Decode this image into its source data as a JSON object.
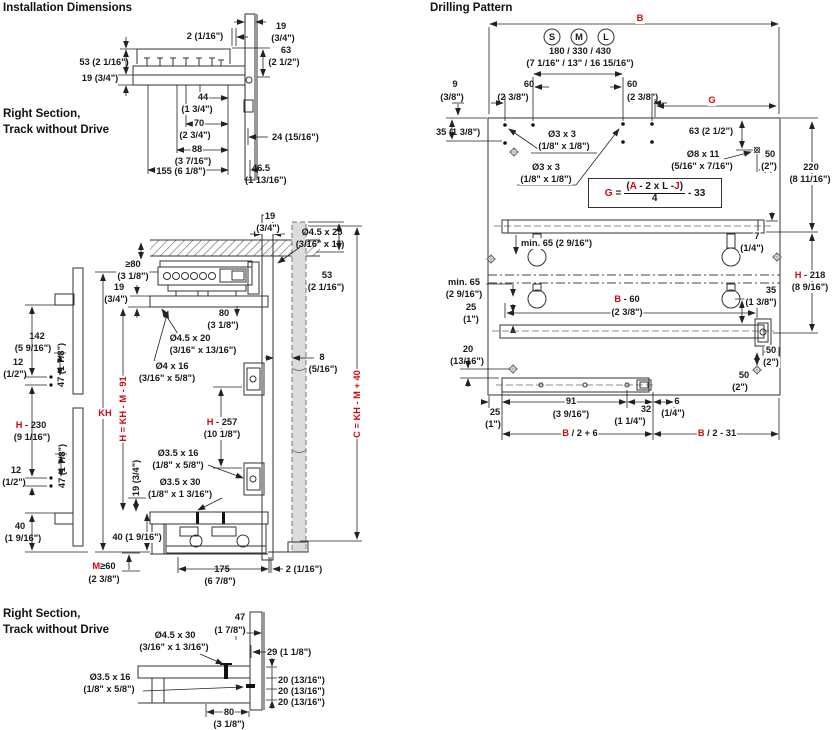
{
  "colors": {
    "red": "#d10a10",
    "ink": "#1a1a1a"
  },
  "headers": {
    "installation": "Installation Dimensions",
    "drilling": "Drilling Pattern",
    "right_section_line1": "Right Section,",
    "right_section_line2": "Track without Drive"
  },
  "drilling": {
    "sizes": [
      "S",
      "M",
      "L"
    ],
    "formula": {
      "lhs": "G",
      "eq": "=",
      "open": "(",
      "a": "A",
      "mid": " - 2 x L -",
      "j": "J",
      "close": ")",
      "den": "4",
      "tail": "- 33"
    }
  },
  "labels": [
    {
      "x": 205,
      "y": 31,
      "t": "2 (1/16\")"
    },
    {
      "x": 281,
      "y": 21,
      "t": "19"
    },
    {
      "x": 283,
      "y": 33,
      "t": "(3/4\")"
    },
    {
      "x": 286,
      "y": 45,
      "t": "63"
    },
    {
      "x": 284,
      "y": 57,
      "t": "(2 1/2\")"
    },
    {
      "x": 104,
      "y": 57,
      "t": "53 (2 1/16\")"
    },
    {
      "x": 100,
      "y": 73,
      "t": "19 (3/4\")"
    },
    {
      "x": 203,
      "y": 92,
      "t": "44",
      "wb": 1
    },
    {
      "x": 197,
      "y": 104,
      "t": "(1 3/4\")",
      "wb": 1
    },
    {
      "x": 199,
      "y": 118,
      "t": "70",
      "wb": 1
    },
    {
      "x": 195,
      "y": 130,
      "t": "(2 3/4\")",
      "wb": 1
    },
    {
      "x": 197,
      "y": 144,
      "t": "88",
      "wb": 1
    },
    {
      "x": 193,
      "y": 156,
      "t": "(3 7/16\")",
      "wb": 1
    },
    {
      "x": 181,
      "y": 166,
      "t": "155 (6 1/8\")",
      "wb": 1
    },
    {
      "x": 272,
      "y": 132,
      "t": "24 (15/16\")",
      "al": "l"
    },
    {
      "x": 252,
      "y": 163,
      "t": "46.5",
      "al": "l"
    },
    {
      "x": 245,
      "y": 175,
      "t": "(1 13/16\")",
      "al": "l"
    },
    {
      "x": 270,
      "y": 211,
      "t": "19",
      "wb": 1
    },
    {
      "x": 268,
      "y": 223,
      "t": "(3/4\")",
      "wb": 1
    },
    {
      "x": 322,
      "y": 227,
      "t": "Ø4.5 x 25"
    },
    {
      "x": 320,
      "y": 239,
      "t": "(3/16\" x 1\")"
    },
    {
      "x": 133,
      "y": 259,
      "t": "≥80",
      "wb": 1
    },
    {
      "x": 133,
      "y": 271,
      "t": "(3 1/8\")",
      "wb": 1
    },
    {
      "x": 119,
      "y": 282,
      "t": "19"
    },
    {
      "x": 116,
      "y": 294,
      "t": "(3/4\")"
    },
    {
      "x": 327,
      "y": 270,
      "t": "53"
    },
    {
      "x": 326,
      "y": 282,
      "t": "(2 1/16\")"
    },
    {
      "x": 224,
      "y": 308,
      "t": "80"
    },
    {
      "x": 223,
      "y": 320,
      "t": "(3 1/8\")"
    },
    {
      "x": 190,
      "y": 333,
      "t": "Ø4.5 x 20",
      "wb": 1
    },
    {
      "x": 203,
      "y": 345,
      "t": "(3/16\" x 13/16\")",
      "wb": 1
    },
    {
      "x": 172,
      "y": 361,
      "t": "Ø4 x 16",
      "wb": 1
    },
    {
      "x": 167,
      "y": 373,
      "t": "(3/16\" x 5/8\")",
      "wb": 1
    },
    {
      "x": 322,
      "y": 352,
      "t": "8"
    },
    {
      "x": 323,
      "y": 364,
      "t": "(5/16\")"
    },
    {
      "x": 222,
      "y": 417,
      "p": [
        {
          "t": "H",
          "r": 1
        },
        {
          "t": " - 257"
        }
      ],
      "wb": 1
    },
    {
      "x": 222,
      "y": 429,
      "t": "(10 1/8\")",
      "wb": 1
    },
    {
      "x": 178,
      "y": 448,
      "t": "Ø3.5 x 16"
    },
    {
      "x": 178,
      "y": 460,
      "t": "(1/8\" x 5/8\")"
    },
    {
      "x": 180,
      "y": 477,
      "t": "Ø3.5 x 30"
    },
    {
      "x": 180,
      "y": 489,
      "t": "(1/8\" x 1 3/16\")"
    },
    {
      "x": 105,
      "y": 408,
      "t": "KH",
      "r": 1,
      "wb": 1
    },
    {
      "x": 123,
      "y": 409,
      "t": "H = KH - M - 91",
      "r": 1,
      "rot": 1,
      "wb": 1
    },
    {
      "x": 136,
      "y": 478,
      "t": "19 (3/4\")",
      "rot": 1,
      "wb": 1
    },
    {
      "x": 357,
      "y": 404,
      "t": "C = KH - M + 40",
      "r": 1,
      "rot": 1,
      "wb": 1
    },
    {
      "x": 37,
      "y": 331,
      "t": "142"
    },
    {
      "x": 33,
      "y": 343,
      "t": "(5 9/16\")"
    },
    {
      "x": 18,
      "y": 357,
      "t": "12"
    },
    {
      "x": 15,
      "y": 369,
      "t": "(1/2\")"
    },
    {
      "x": 61,
      "y": 365,
      "t": "47 (1 7/8\")",
      "rot": 1
    },
    {
      "x": 31,
      "y": 420,
      "p": [
        {
          "t": "H",
          "r": 1
        },
        {
          "t": " - 230"
        }
      ]
    },
    {
      "x": 32,
      "y": 432,
      "t": "(9 1/16\")"
    },
    {
      "x": 16,
      "y": 465,
      "t": "12"
    },
    {
      "x": 14,
      "y": 477,
      "t": "(1/2\")"
    },
    {
      "x": 62,
      "y": 466,
      "t": "47 (1 7/8\")",
      "rot": 1
    },
    {
      "x": 20,
      "y": 521,
      "t": "40"
    },
    {
      "x": 23,
      "y": 533,
      "t": "(1 9/16\")"
    },
    {
      "x": 137,
      "y": 532,
      "t": "40 (1 9/16\")",
      "wb": 1
    },
    {
      "x": 104,
      "y": 561,
      "p": [
        {
          "t": "M",
          "r": 1
        },
        {
          "t": "≥60"
        }
      ]
    },
    {
      "x": 104,
      "y": 574,
      "t": "(2 3/8\")"
    },
    {
      "x": 222,
      "y": 564,
      "t": "175"
    },
    {
      "x": 220,
      "y": 576,
      "t": "(6 7/8\")"
    },
    {
      "x": 304,
      "y": 564,
      "t": "2 (1/16\")"
    },
    {
      "x": 240,
      "y": 612,
      "t": "47",
      "wb": 1
    },
    {
      "x": 230,
      "y": 625,
      "t": "(1 7/8\")",
      "wb": 1
    },
    {
      "x": 175,
      "y": 630,
      "t": "Ø4.5 x 30"
    },
    {
      "x": 174,
      "y": 642,
      "t": "(3/16\" x 1 3/16\")"
    },
    {
      "x": 267,
      "y": 647,
      "t": "29 (1 1/8\")",
      "al": "l"
    },
    {
      "x": 110,
      "y": 672,
      "t": "Ø3.5 x 16"
    },
    {
      "x": 109,
      "y": 684,
      "t": "(1/8\" x 5/8\")"
    },
    {
      "x": 278,
      "y": 675,
      "t": "20 (13/16\")",
      "al": "l"
    },
    {
      "x": 278,
      "y": 686,
      "t": "20 (13/16\")",
      "al": "l"
    },
    {
      "x": 278,
      "y": 697,
      "t": "20 (13/16\")",
      "al": "l"
    },
    {
      "x": 229,
      "y": 707,
      "t": "80",
      "wb": 1
    },
    {
      "x": 229,
      "y": 719,
      "t": "(3 1/8\")"
    },
    {
      "x": 640,
      "y": 13,
      "t": "B",
      "r": 1,
      "wb": 1
    },
    {
      "x": 552,
      "y": 32,
      "t": "S",
      "n": "size-s-label"
    },
    {
      "x": 579,
      "y": 32,
      "t": "M",
      "n": "size-m-label"
    },
    {
      "x": 606,
      "y": 32,
      "t": "L",
      "n": "size-l-label"
    },
    {
      "x": 580,
      "y": 46,
      "t": "180 / 330 / 430"
    },
    {
      "x": 580,
      "y": 58,
      "t": "(7 1/16\" / 13\" / 16 15/16\")"
    },
    {
      "x": 529,
      "y": 79,
      "t": "60"
    },
    {
      "x": 513,
      "y": 92,
      "t": "(2 3/8\")"
    },
    {
      "x": 627,
      "y": 79,
      "t": "60",
      "al": "l"
    },
    {
      "x": 627,
      "y": 92,
      "t": "(2 3/8\")",
      "al": "l"
    },
    {
      "x": 455,
      "y": 79,
      "t": "9"
    },
    {
      "x": 452,
      "y": 92,
      "t": "(3/8\")"
    },
    {
      "x": 712,
      "y": 95,
      "t": "G",
      "r": 1,
      "wb": 1
    },
    {
      "x": 436,
      "y": 127,
      "t": "35 (1 3/8\")",
      "al": "l"
    },
    {
      "x": 562,
      "y": 129,
      "t": "Ø3 x 3",
      "wb": 1
    },
    {
      "x": 564,
      "y": 141,
      "t": "(1/8\" x 1/8\")",
      "wb": 1
    },
    {
      "x": 546,
      "y": 162,
      "t": "Ø3 x 3",
      "wb": 1
    },
    {
      "x": 546,
      "y": 174,
      "t": "(1/8\" x 1/8\")",
      "wb": 1
    },
    {
      "x": 711,
      "y": 126,
      "t": "63 (2 1/2\")"
    },
    {
      "x": 703,
      "y": 149,
      "t": "Ø8 x 11",
      "wb": 1
    },
    {
      "x": 702,
      "y": 161,
      "t": "(5/16\" x 7/16\")",
      "wb": 1
    },
    {
      "x": 770,
      "y": 149,
      "t": "50",
      "wb": 1
    },
    {
      "x": 769,
      "y": 161,
      "t": "(2\")",
      "wb": 1
    },
    {
      "x": 811,
      "y": 162,
      "t": "220",
      "wb": 1
    },
    {
      "x": 810,
      "y": 174,
      "t": "(8 11/16\")",
      "wb": 1
    },
    {
      "x": 520,
      "y": 238,
      "t": "min. 65 (2 9/16\")",
      "al": "l",
      "wb": 1
    },
    {
      "x": 757,
      "y": 231,
      "t": "7",
      "wb": 1
    },
    {
      "x": 752,
      "y": 243,
      "t": "(1/4\")",
      "wb": 1
    },
    {
      "x": 464,
      "y": 277,
      "t": "min. 65"
    },
    {
      "x": 464,
      "y": 289,
      "t": "(2 9/16\")"
    },
    {
      "x": 471,
      "y": 302,
      "t": "25"
    },
    {
      "x": 471,
      "y": 314,
      "t": "(1\")"
    },
    {
      "x": 627,
      "y": 294,
      "p": [
        {
          "t": "B",
          "r": 1
        },
        {
          "t": " - 60"
        }
      ],
      "wb": 1
    },
    {
      "x": 627,
      "y": 307,
      "t": "(2 3/8\")",
      "wb": 1
    },
    {
      "x": 771,
      "y": 285,
      "t": "35",
      "wb": 1
    },
    {
      "x": 761,
      "y": 297,
      "t": "(1 3/8\")",
      "wb": 1
    },
    {
      "x": 810,
      "y": 270,
      "p": [
        {
          "t": "H",
          "r": 1
        },
        {
          "t": " - 218"
        }
      ],
      "wb": 1
    },
    {
      "x": 810,
      "y": 282,
      "t": "(8 9/16\")",
      "wb": 1
    },
    {
      "x": 771,
      "y": 345,
      "t": "50",
      "wb": 1
    },
    {
      "x": 771,
      "y": 357,
      "t": "(2\")",
      "wb": 1
    },
    {
      "x": 744,
      "y": 370,
      "t": "50",
      "wb": 1
    },
    {
      "x": 740,
      "y": 382,
      "t": "(2\")",
      "wb": 1
    },
    {
      "x": 468,
      "y": 344,
      "t": "20"
    },
    {
      "x": 467,
      "y": 356,
      "t": "(13/16\")"
    },
    {
      "x": 495,
      "y": 407,
      "t": "25"
    },
    {
      "x": 493,
      "y": 419,
      "t": "(1\")"
    },
    {
      "x": 571,
      "y": 396,
      "t": "91",
      "wb": 1
    },
    {
      "x": 571,
      "y": 409,
      "t": "(3 9/16\")"
    },
    {
      "x": 646,
      "y": 404,
      "t": "32",
      "wb": 1
    },
    {
      "x": 630,
      "y": 416,
      "t": "(1 1/4\")"
    },
    {
      "x": 677,
      "y": 396,
      "t": "6",
      "wb": 1
    },
    {
      "x": 673,
      "y": 408,
      "t": "(1/4\")"
    },
    {
      "x": 580,
      "y": 428,
      "p": [
        {
          "t": "B",
          "r": 1
        },
        {
          "t": " / 2 + 6"
        }
      ],
      "wb": 1
    },
    {
      "x": 717,
      "y": 428,
      "p": [
        {
          "t": "B",
          "r": 1
        },
        {
          "t": " / 2 - 31"
        }
      ],
      "wb": 1
    }
  ]
}
